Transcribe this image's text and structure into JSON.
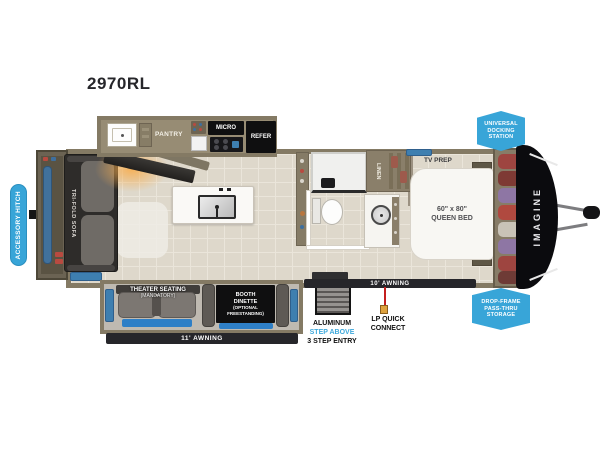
{
  "title": "2970RL",
  "callouts": {
    "accessory_hitch": "ACCESSORY HITCH",
    "universal_docking": [
      "UNIVERSAL",
      "DOCKING",
      "STATION"
    ],
    "drop_frame": [
      "DROP-FRAME",
      "PASS-THRU",
      "STORAGE"
    ]
  },
  "kitchen": {
    "pantry": "PANTRY",
    "micro": "MICRO",
    "refer": "REFER"
  },
  "living": {
    "sofa": "TRI-FOLD SOFA",
    "theater": [
      "THEATER SEATING",
      "(MANDATORY)"
    ],
    "dinette": [
      "BOOTH",
      "DINETTE",
      "(OPTIONAL",
      "FREESTANDING)"
    ]
  },
  "bath": {
    "linen": "LINEN"
  },
  "bedroom": {
    "tv_prep": "TV PREP",
    "bed": [
      "60\" x 80\"",
      "QUEEN BED"
    ]
  },
  "exterior": {
    "brand": "IMAGINE",
    "awning_11": "11' AWNING",
    "awning_10": "10' AWNING",
    "entry": [
      "ALUMINUM",
      "STEP ABOVE",
      "3 STEP ENTRY"
    ],
    "lp": [
      "LP QUICK",
      "CONNECT"
    ]
  },
  "colors": {
    "accent_blue": "#38a5d8",
    "window_blue": "#2e7fc6",
    "wall_tan": "#847a64",
    "cap_black": "#0b0b0e"
  }
}
